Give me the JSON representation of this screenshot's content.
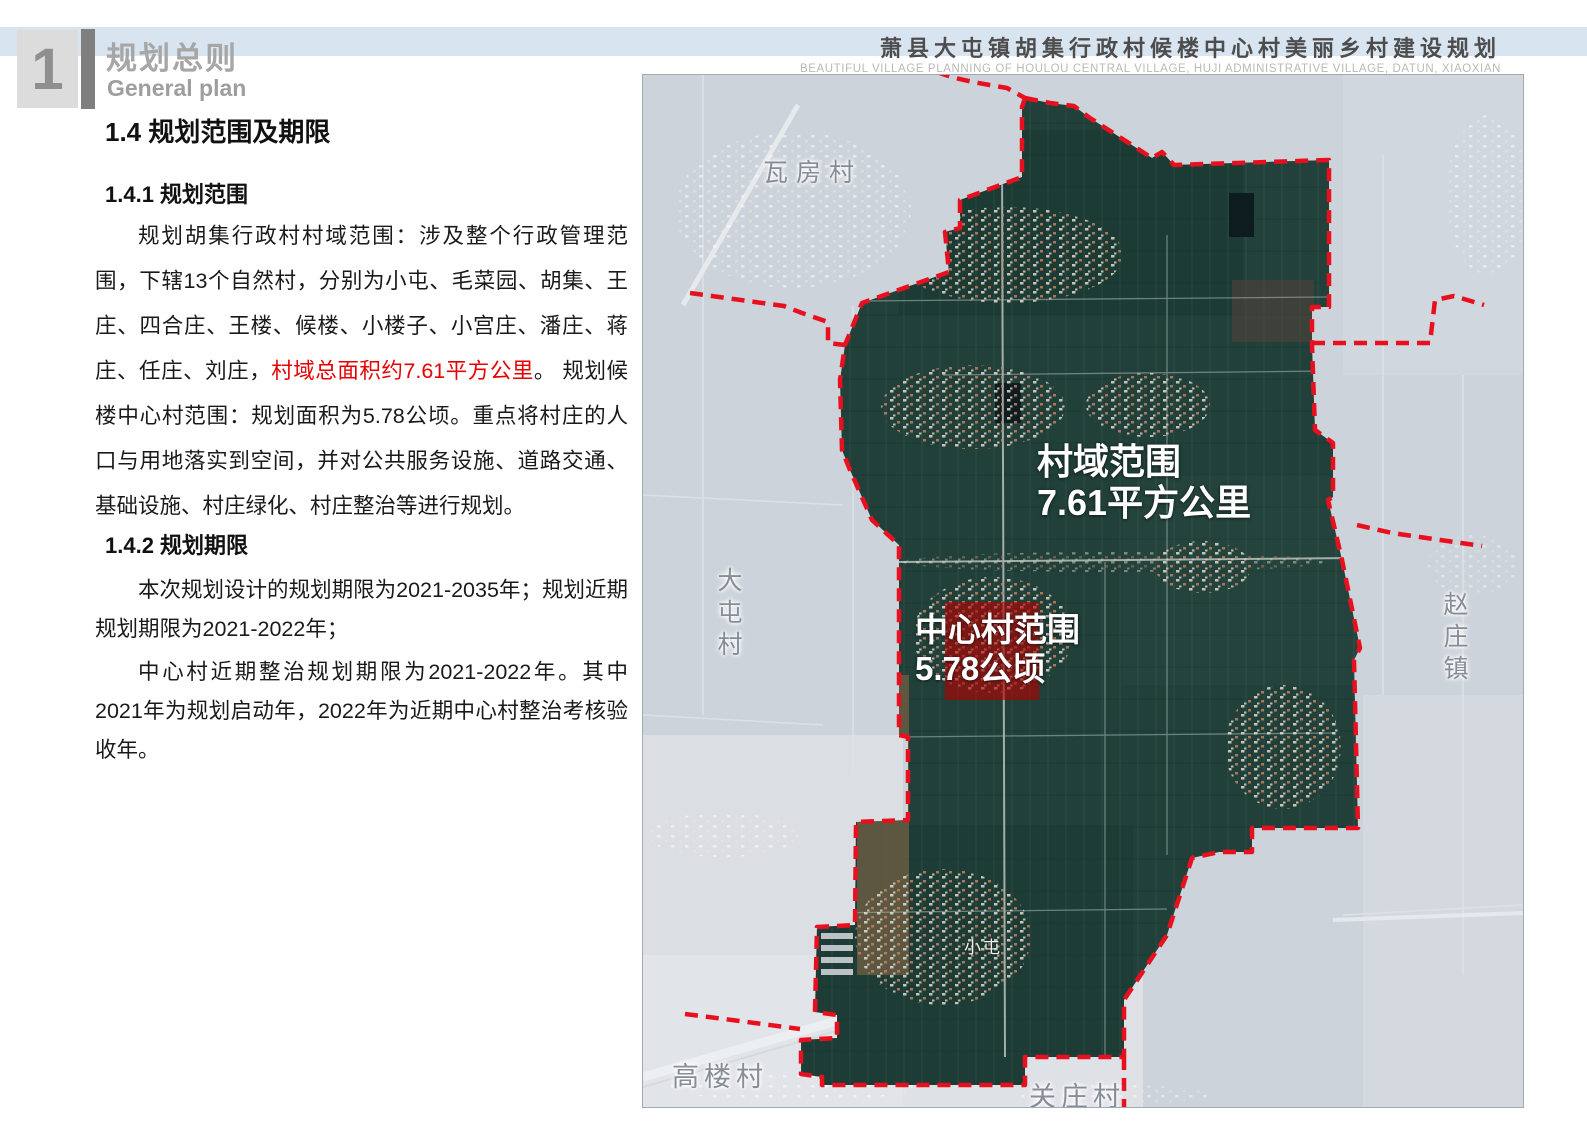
{
  "header": {
    "chapter": {
      "number": "1",
      "title_zh": "规划总则",
      "title_en": "General plan"
    },
    "doc_title_zh": "萧县大屯镇胡集行政村候楼中心村美丽乡村建设规划",
    "doc_title_en": "BEAUTIFUL VILLAGE PLANNING OF HOULOU CENTRAL VILLAGE, HUJI ADMINISTRATIVE VILLAGE, DATUN, XIAOXIAN"
  },
  "content": {
    "section_title": "1.4 规划范围及期限",
    "scope": {
      "title": "1.4.1 规划范围",
      "para_start": "规划胡集行政村村域范围：涉及整个行政管理范围，下辖13个自然村，分别为小屯、毛菜园、胡集、王庄、四合庄、王楼、候楼、小楼子、小宫庄、潘庄、蒋庄、任庄、刘庄，",
      "para_red": "村域总面积约7.61平方公里",
      "para_end": "。 规划候楼中心村范围：规划面积为5.78公顷。重点将村庄的人口与用地落实到空间，并对公共服务设施、道路交通、基础设施、村庄绿化、村庄整治等进行规划。"
    },
    "period": {
      "title": "1.4.2 规划期限",
      "para1": "本次规划设计的规划期限为2021-2035年；规划近期规划期限为2021-2022年；",
      "para2": "中心村近期整治规划期限为2021-2022年。其中2021年为规划启动年，2022年为近期中心村整治考核验收年。"
    }
  },
  "map": {
    "annotation_domain": {
      "line1": "村域范围",
      "line2": "7.61平方公里"
    },
    "annotation_center": {
      "line1": "中心村范围",
      "line2": "5.78公顷"
    },
    "places": {
      "wafang": "瓦房村",
      "datun": "大屯村",
      "zhaozhuang": "赵庄镇",
      "gaolou": "高楼村",
      "guanzhuang": "关庄村",
      "xiaotun": "小屯"
    },
    "colors": {
      "boundary": "#e8101e",
      "domain_fill": "#21403a",
      "outside": "#ccd3da",
      "center_highlight": "#b30000"
    }
  }
}
